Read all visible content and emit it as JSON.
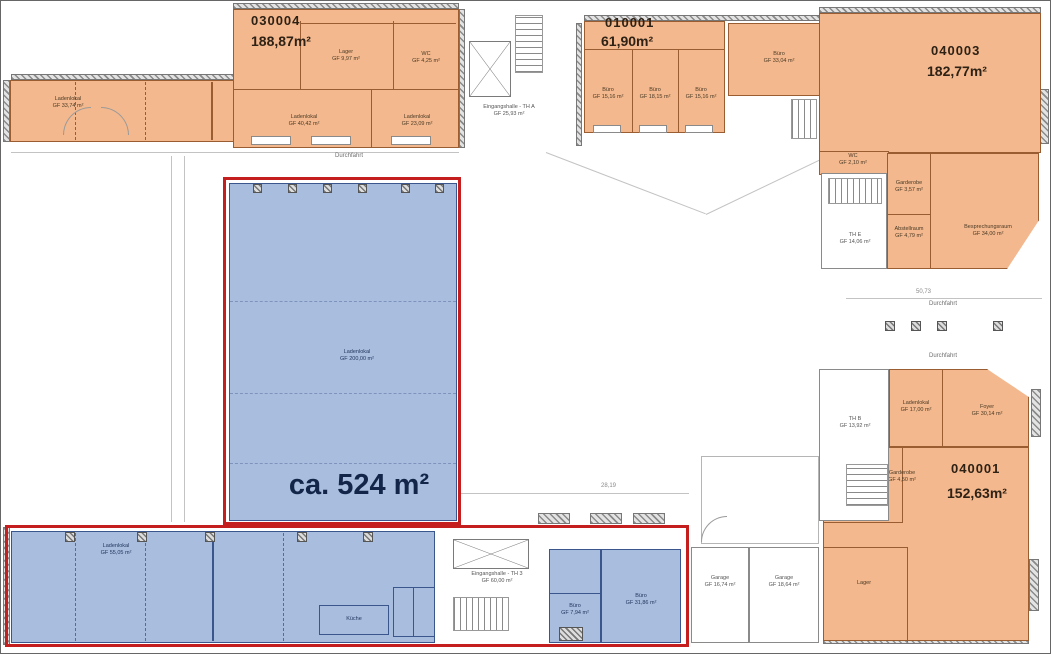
{
  "units": {
    "u030004": {
      "id": "030004",
      "area": "188,87m²"
    },
    "u010001": {
      "id": "010001",
      "area": "61,90m²"
    },
    "u040003": {
      "id": "040003",
      "area": "182,77m²"
    },
    "u040001": {
      "id": "040001",
      "area": "152,63m²"
    }
  },
  "highlight": {
    "total_area": "ca. 524 m²"
  },
  "rooms": {
    "strip_nw": {
      "name": "Ladenlokal",
      "area": "GF 33,74 m²"
    },
    "laden_a": {
      "name": "Ladenlokal",
      "area": "GF 40,42 m²"
    },
    "laden_b": {
      "name": "Ladenlokal",
      "area": "GF 23,09 m²"
    },
    "lager_n": {
      "name": "Lager",
      "area": "GF 9,97 m²"
    },
    "wc_n": {
      "name": "WC",
      "area": "GF 4,25 m²"
    },
    "th_a": {
      "name": "Eingangshalle - TH A",
      "area": "GF 25,93 m²"
    },
    "buero_a": {
      "name": "Büro",
      "area": "GF 15,16 m²"
    },
    "buero_b": {
      "name": "Büro",
      "area": "GF 18,15 m²"
    },
    "buero_c": {
      "name": "Büro",
      "area": "GF 15,16 m²"
    },
    "buero_d": {
      "name": "Büro",
      "area": "GF 33,04 m²"
    },
    "wc_e": {
      "name": "WC",
      "area": "GF 2,10 m²"
    },
    "garderobe_e": {
      "name": "Garderobe",
      "area": "GF 3,57 m²"
    },
    "abstellraum": {
      "name": "Abstellraum",
      "area": "GF 4,79 m²"
    },
    "besprechung": {
      "name": "Besprechungsraum",
      "area": "GF 34,00 m²"
    },
    "th_e": {
      "name": "TH E",
      "area": "GF 14,06 m²"
    },
    "hall": {
      "name": "Ladenlokal",
      "area": "GF 200,00 m²"
    },
    "strip_sw": {
      "name": "Ladenlokal",
      "area": "GF 55,05 m²"
    },
    "kueche": {
      "name": "Küche"
    },
    "th_3": {
      "name": "Eingangshalle - TH 3",
      "area": "GF 60,00 m²"
    },
    "buero_s1": {
      "name": "Büro",
      "area": "GF 7,94 m²"
    },
    "buero_s2": {
      "name": "Büro",
      "area": "GF 31,86 m²"
    },
    "garage_a": {
      "name": "Garage",
      "area": "GF 16,74 m²"
    },
    "garage_b": {
      "name": "Garage",
      "area": "GF 18,64 m²"
    },
    "th_b": {
      "name": "TH B",
      "area": "GF 13,92 m²"
    },
    "laden_se": {
      "name": "Ladenlokal",
      "area": "GF 17,00 m²"
    },
    "foyer": {
      "name": "Foyer",
      "area": "GF 30,14 m²"
    },
    "garderobe_s": {
      "name": "Garderobe",
      "area": "GF 4,50 m²"
    },
    "lager_s": {
      "name": "Lager"
    }
  },
  "annotations": {
    "durchfahrt": "Durchfahrt"
  },
  "dims": {
    "d_bottom": "28,19",
    "d_right": "50,73"
  },
  "colors": {
    "unit_fill": "#f3b88d",
    "unit_line": "#9a5c31",
    "highlight_fill": "#a9bedf",
    "highlight_line": "#3a568c",
    "outline_red": "#c41e1e",
    "label_dark": "#2e2115",
    "highlight_text": "#13264a"
  }
}
